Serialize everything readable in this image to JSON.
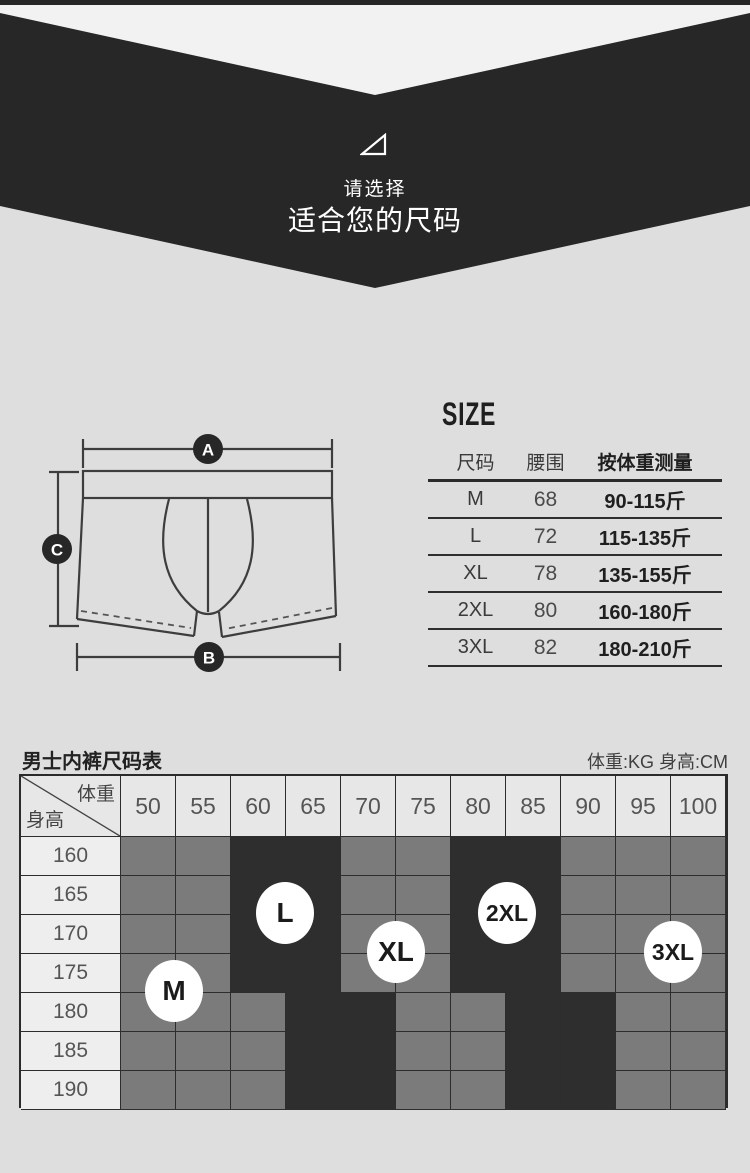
{
  "page": {
    "bg": "#dedede",
    "accent_dark": "#272727"
  },
  "hero": {
    "icon": "triangle-outline-icon",
    "subtitle": "请选择",
    "title": "适合您的尺码"
  },
  "diagram": {
    "labels": {
      "a": "A",
      "b": "B",
      "c": "C"
    }
  },
  "size_guide": {
    "title": "SIZE",
    "headers": [
      "尺码",
      "腰围",
      "按体重测量"
    ],
    "rows": [
      {
        "size": "M",
        "waist": "68",
        "weight": "90-115斤"
      },
      {
        "size": "L",
        "waist": "72",
        "weight": "115-135斤"
      },
      {
        "size": "XL",
        "waist": "78",
        "weight": "135-155斤"
      },
      {
        "size": "2XL",
        "waist": "80",
        "weight": "160-180斤"
      },
      {
        "size": "3XL",
        "waist": "82",
        "weight": "180-210斤"
      }
    ]
  },
  "size_chart": {
    "title": "男士内裤尺码表",
    "units": "体重:KG  身高:CM",
    "corner_top": "体重",
    "corner_bottom": "身高",
    "weights": [
      "50",
      "55",
      "60",
      "65",
      "70",
      "75",
      "80",
      "85",
      "90",
      "95",
      "100"
    ],
    "heights": [
      "160",
      "165",
      "170",
      "175",
      "180",
      "185",
      "190"
    ],
    "cells": [
      [
        "g",
        "g",
        "d",
        "d",
        "g",
        "g",
        "d",
        "d",
        "g",
        "g",
        "g"
      ],
      [
        "g",
        "g",
        "d",
        "d",
        "g",
        "g",
        "d",
        "d",
        "g",
        "g",
        "g"
      ],
      [
        "g",
        "g",
        "d",
        "d",
        "g",
        "g",
        "d",
        "d",
        "g",
        "g",
        "g"
      ],
      [
        "g",
        "g",
        "d",
        "d",
        "g",
        "g",
        "d",
        "d",
        "g",
        "g",
        "g"
      ],
      [
        "g",
        "g",
        "g",
        "d",
        "d",
        "g",
        "g",
        "d",
        "d",
        "g",
        "g"
      ],
      [
        "g",
        "g",
        "g",
        "d",
        "d",
        "g",
        "g",
        "d",
        "d",
        "g",
        "g"
      ],
      [
        "g",
        "g",
        "g",
        "d",
        "d",
        "g",
        "g",
        "d",
        "d",
        "g",
        "g"
      ]
    ],
    "badges": [
      {
        "label": "M",
        "x": 174,
        "y": 991
      },
      {
        "label": "L",
        "x": 285,
        "y": 913
      },
      {
        "label": "XL",
        "x": 396,
        "y": 952
      },
      {
        "label": "2XL",
        "x": 507,
        "y": 913
      },
      {
        "label": "3XL",
        "x": 673,
        "y": 952
      }
    ],
    "colors": {
      "gray": "#7b7b7b",
      "dark": "#2e2e2e"
    }
  },
  "chart_data": {
    "type": "heatmap",
    "title": "男士内裤尺码表",
    "xlabel": "体重 (KG)",
    "ylabel": "身高 (CM)",
    "x": [
      50,
      55,
      60,
      65,
      70,
      75,
      80,
      85,
      90,
      95,
      100
    ],
    "y": [
      160,
      165,
      170,
      175,
      180,
      185,
      190
    ],
    "values": [
      [
        1,
        1,
        2,
        2,
        1,
        1,
        2,
        2,
        1,
        1,
        1
      ],
      [
        1,
        1,
        2,
        2,
        1,
        1,
        2,
        2,
        1,
        1,
        1
      ],
      [
        1,
        1,
        2,
        2,
        1,
        1,
        2,
        2,
        1,
        1,
        1
      ],
      [
        1,
        1,
        2,
        2,
        1,
        1,
        2,
        2,
        1,
        1,
        1
      ],
      [
        1,
        1,
        1,
        2,
        2,
        1,
        1,
        2,
        2,
        1,
        1
      ],
      [
        1,
        1,
        1,
        2,
        2,
        1,
        1,
        2,
        2,
        1,
        1
      ],
      [
        1,
        1,
        1,
        2,
        2,
        1,
        1,
        2,
        2,
        1,
        1
      ]
    ],
    "annotations": [
      {
        "label": "M",
        "weight": 52.5,
        "height": 177.5
      },
      {
        "label": "L",
        "weight": 62.5,
        "height": 167.5
      },
      {
        "label": "XL",
        "weight": 72.5,
        "height": 172.5
      },
      {
        "label": "2XL",
        "weight": 82.5,
        "height": 167.5
      },
      {
        "label": "3XL",
        "weight": 97.5,
        "height": 172.5
      }
    ]
  }
}
